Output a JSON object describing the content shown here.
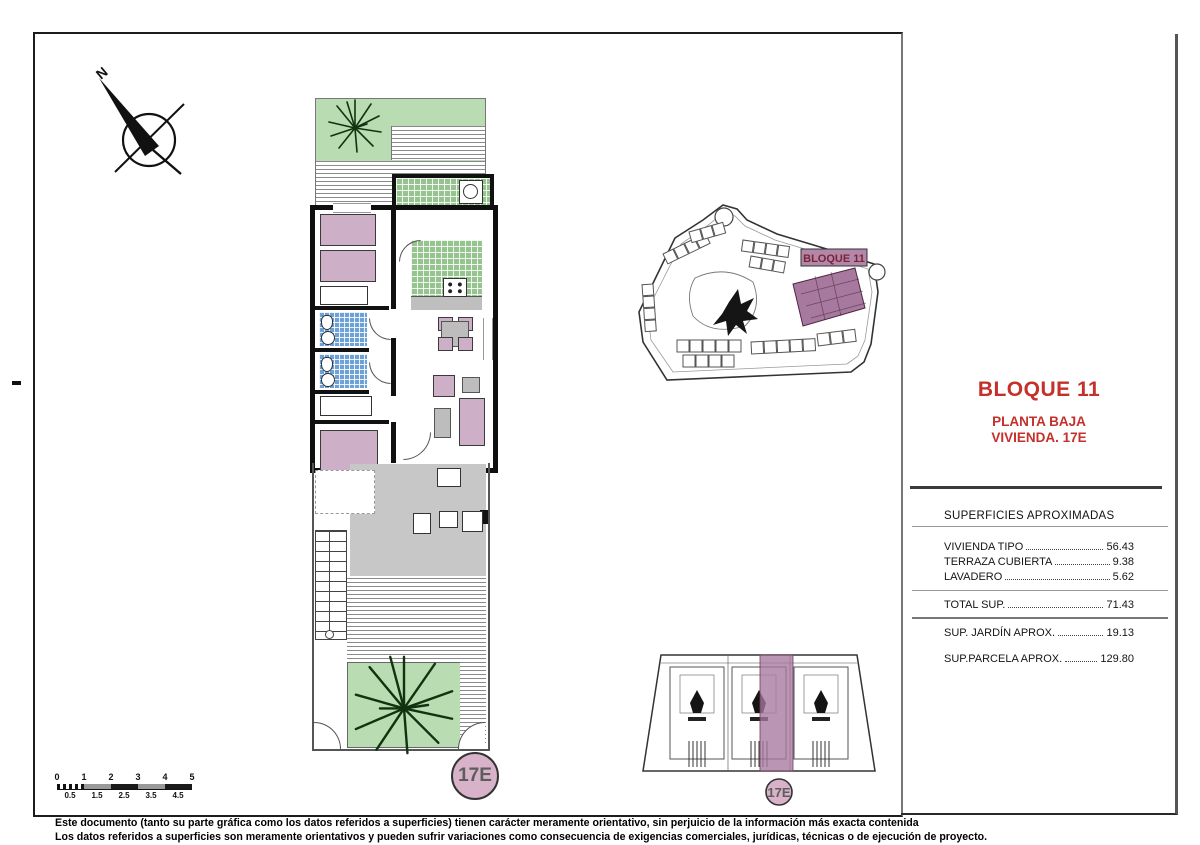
{
  "sheet": {
    "compass": {
      "label": "N"
    },
    "floor_plan": {
      "unit_badge": "17E"
    },
    "key_plan": {
      "unit_badge": "17E"
    },
    "site_plan": {
      "highlight_label": "BLOQUE 11"
    },
    "title_block": {
      "block": "BLOQUE 11",
      "floor": "PLANTA BAJA",
      "unit": "VIVIENDA. 17E"
    },
    "surfaces": {
      "header": "SUPERFICIES APROXIMADAS",
      "rows": [
        {
          "label": "VIVIENDA TIPO",
          "value": "56.43"
        },
        {
          "label": "TERRAZA CUBIERTA",
          "value": "9.38"
        },
        {
          "label": "LAVADERO",
          "value": "5.62"
        },
        {
          "label": "TOTAL SUP.",
          "value": "71.43"
        },
        {
          "label": "SUP. JARDÍN APROX.",
          "value": "19.13"
        },
        {
          "label": "SUP.PARCELA APROX.",
          "value": "129.80"
        }
      ]
    },
    "scale_bar": {
      "top": [
        "0",
        "1",
        "2",
        "3",
        "4",
        "5"
      ],
      "bottom": [
        "0.5",
        "1.5",
        "2.5",
        "3.5",
        "4.5"
      ]
    },
    "disclaimer": {
      "line1": "Este documento (tanto su parte gráfica como los datos referidos a superficies) tienen carácter meramente orientativo, sin perjuicio de la información más exacta contenida",
      "line2": "Los datos referidos a superficies son meramente orientativos y pueden sufrir variaciones como consecuencia de exigencias comerciales, jurídicas, técnicas o de ejecución de proyecto."
    },
    "colors": {
      "accent_red": "#c4302a",
      "highlight_purple": "#a8799f",
      "garden_green": "#b9dcb3",
      "badge_pink": "#d8b2c8"
    }
  }
}
